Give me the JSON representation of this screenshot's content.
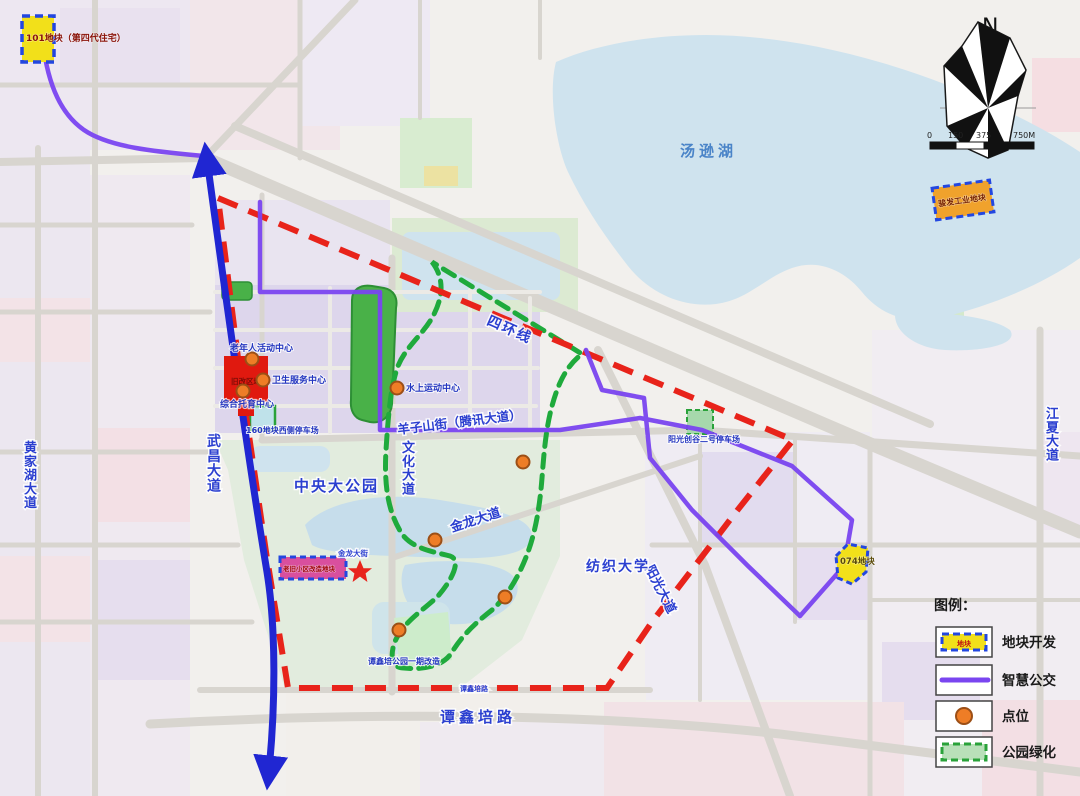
{
  "legend": {
    "title": "图例：",
    "items": [
      {
        "label": "地块开发",
        "swatch_text": "地块"
      },
      {
        "label": "智慧公交"
      },
      {
        "label": "点位"
      },
      {
        "label": "公园绿化"
      }
    ]
  },
  "compass": {
    "north": "N"
  },
  "scalebar": {
    "t0": "0",
    "t1": "150",
    "t2": "375",
    "t3": "750M"
  },
  "plots": {
    "p101": "101地块（第四代住宅）",
    "industrial": "骏发工业地块",
    "p074": "074地块",
    "renewal": "老旧小区改造地块",
    "red_block": "旧改区域"
  },
  "pois": {
    "senior_center": "老年人活动中心",
    "health_center": "卫生服务中心",
    "childcare_center": "综合托育中心",
    "parking_160": "160地块西侧停车场",
    "water_sports": "水上运动中心",
    "parking_sunshine": "阳光创谷二号停车场",
    "tanxinpei_park": "谭鑫培公园一期改造"
  },
  "roads": {
    "huangjiahu": "黄家湖大道",
    "wuchang": "武昌大道",
    "wenhua": "文化大道",
    "jinlong": "金龙大道",
    "jinlong_st": "金龙大街",
    "yangzishan": "羊子山街（腾讯大道）",
    "sihuan": "四环线",
    "yangguang": "阳光大道",
    "jiangxia": "江夏大道",
    "tanxinpei": "谭鑫培路",
    "tanxinpei_minor": "谭鑫培路"
  },
  "places": {
    "tangxun_lake": "汤逊湖",
    "central_park": "中央大公园",
    "textile_university": "纺织大学"
  },
  "colors": {
    "plot_yellow": "#f2e01a",
    "plot_orange": "#f0a22c",
    "plot_border_blue": "#2347e0",
    "bus_purple": "#7a45f0",
    "route_blue": "#2026d2",
    "boundary_red": "#e8231a",
    "park_green": "#1faa3c",
    "poi_orange": "#ee7d26",
    "block_red": "#e0190f"
  }
}
